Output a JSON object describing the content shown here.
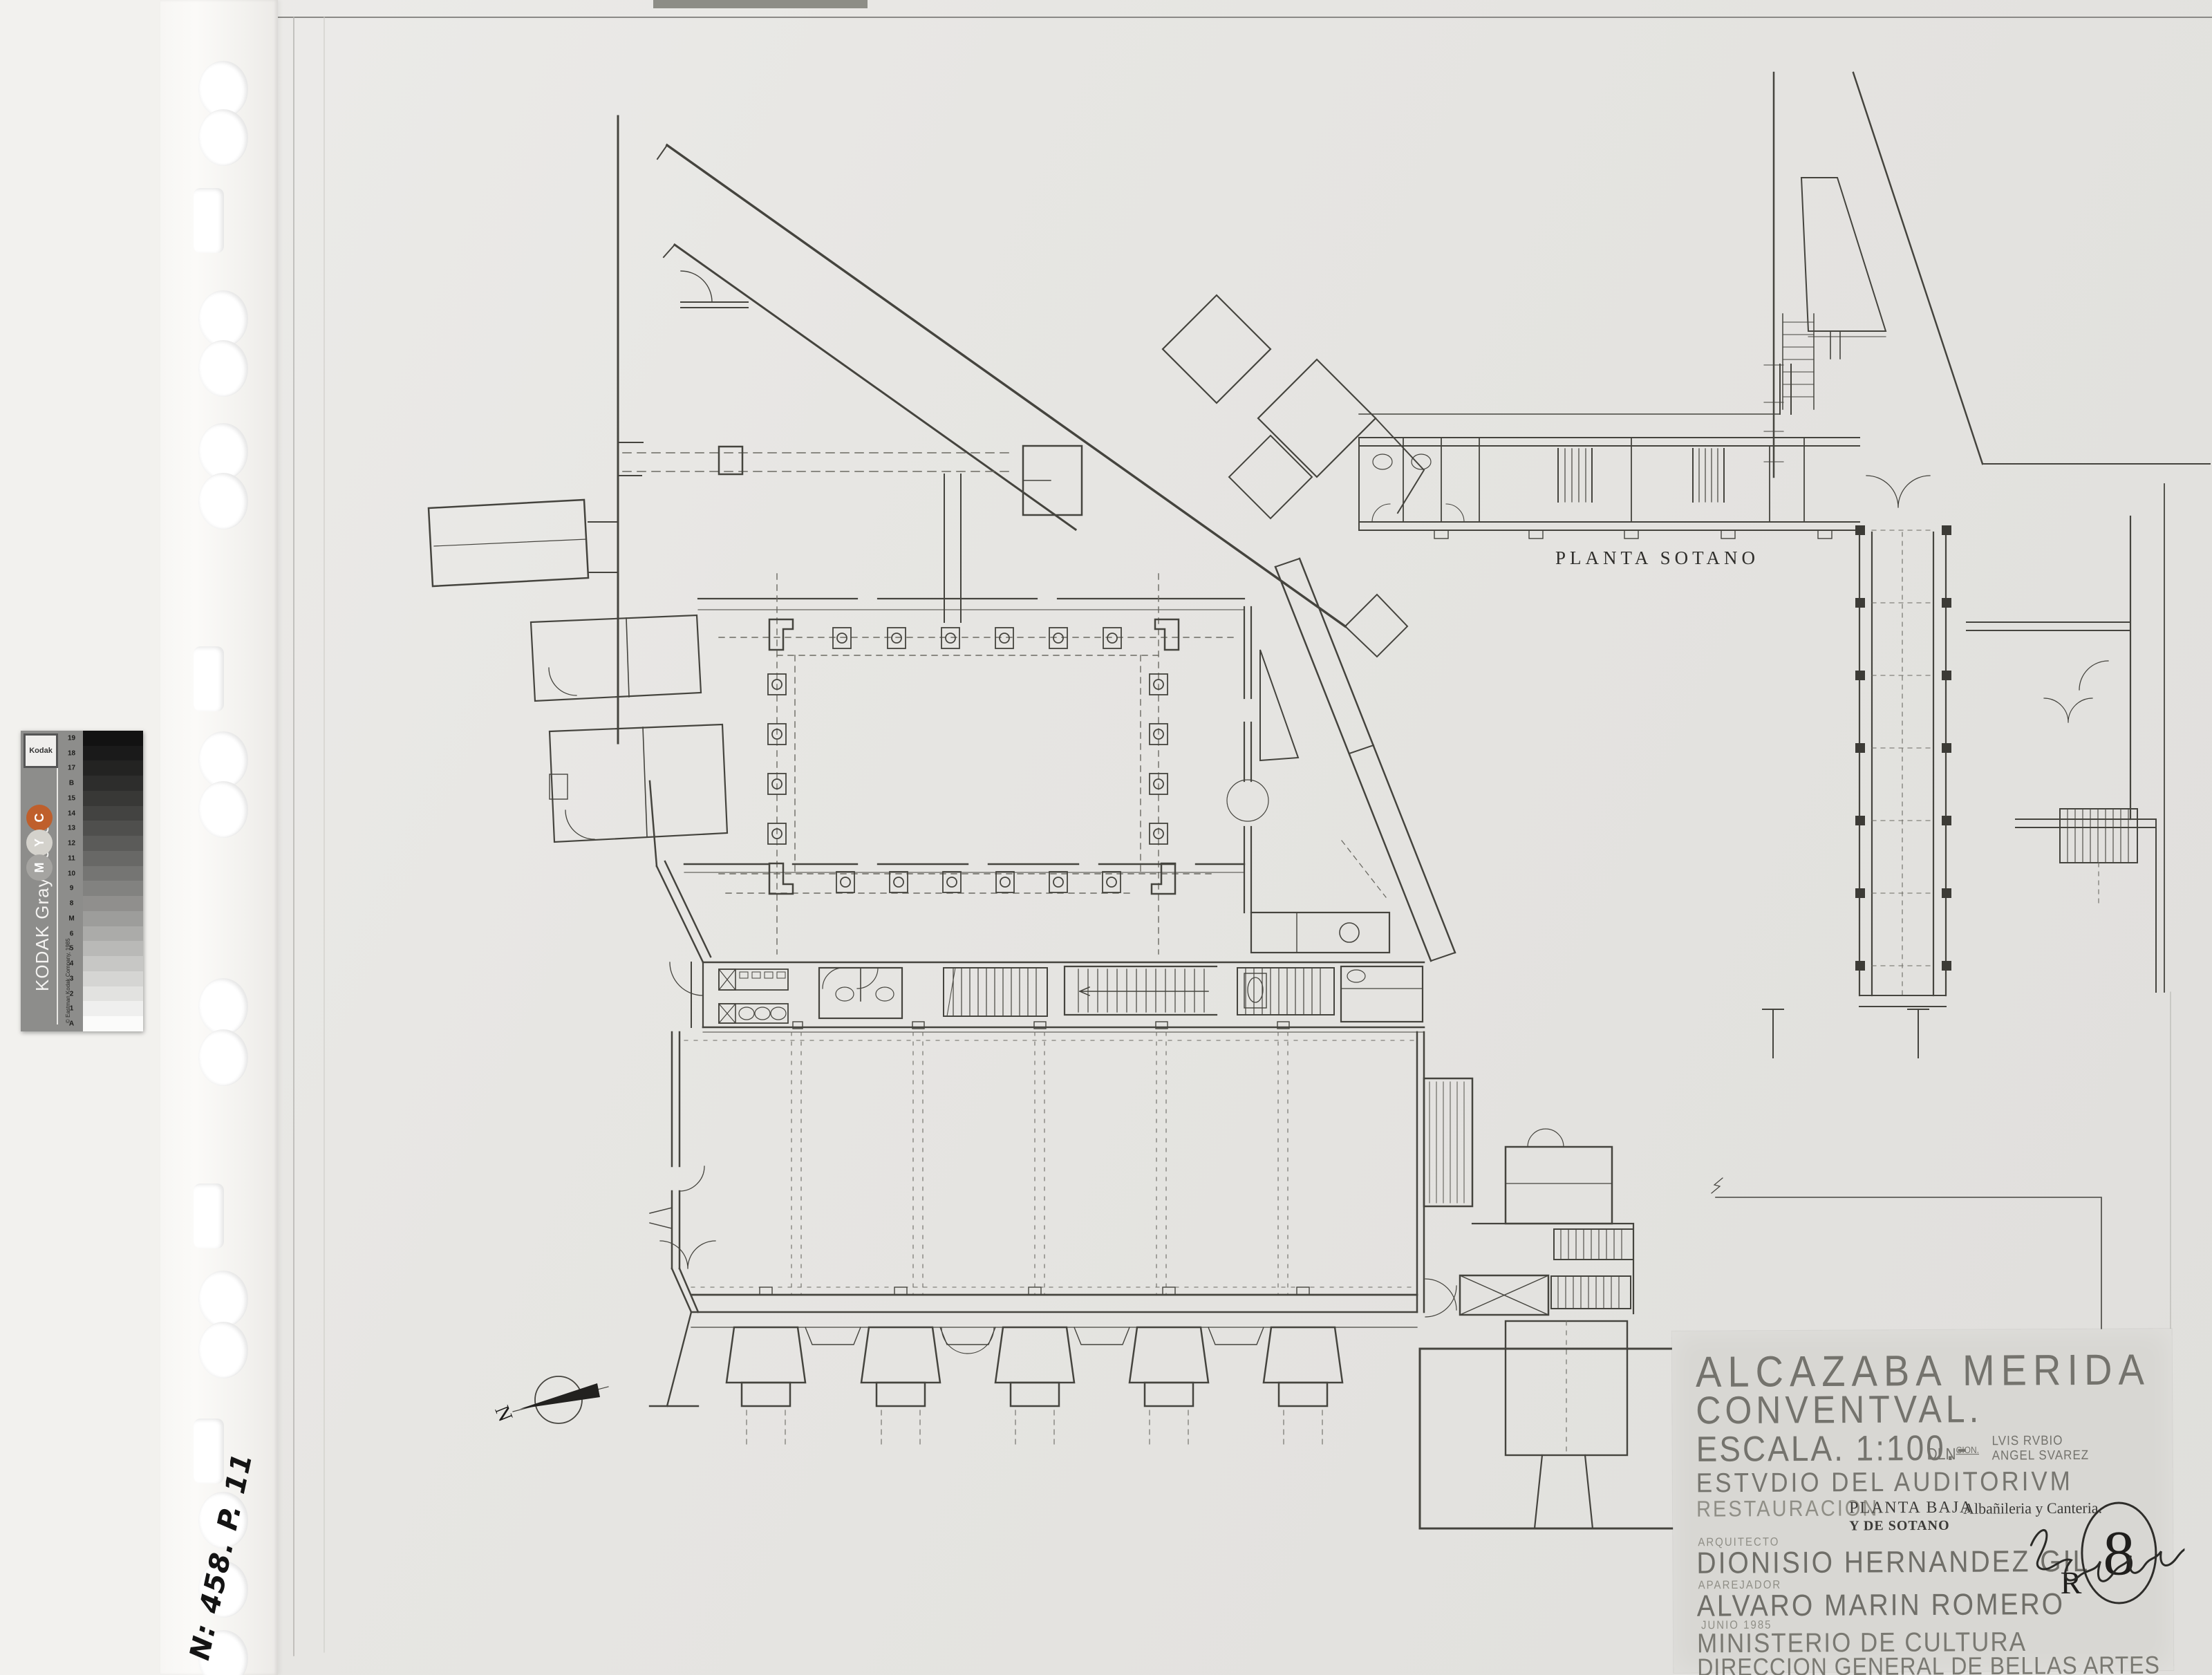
{
  "sheet": {
    "bg": "#e6e5e2",
    "line_color": "#45443e",
    "dash_color": "#6b6a63",
    "title_block_bg": "#d8d7d3"
  },
  "labels": {
    "sotano_title": "PLANTA SOTANO"
  },
  "title_block": {
    "line1": "ALCAZABA MERIDA",
    "line2": "CONVENTVAL.",
    "line3": "ESCALA. 1:100.-",
    "dln_label": "DLN",
    "dln_sup": "CION.",
    "drafters": [
      "LVIS RVBIO",
      "ANGEL SVAREZ"
    ],
    "line4": "ESTVDIO DEL AUDITORIVM",
    "restauracion": "RESTAURACION",
    "planta_baja": "PLANTA BAJA",
    "y_de_sotano": "Y DE SOTANO",
    "albanileria": "Albañileria y Canteria.",
    "arquitecto_label": "ARQUITECTO",
    "arquitecto": "DIONISIO HERNANDEZ GIL",
    "aparejador_label": "APAREJADOR",
    "aparejador": "ALVARO MARIN ROMERO",
    "date": "JUNIO 1985",
    "ministerio": "MINISTERIO DE CULTURA",
    "direccion": "DIRECCION GENERAL DE BELLAS ARTES",
    "revision_letter": "R",
    "revision_number": "8"
  },
  "annotations": {
    "handwritten_ref": "N: 458. P. 11",
    "north_letter": "N"
  },
  "kodak": {
    "brand": "Kodak",
    "title": "KODAK Gray Scale",
    "copyright": "© Eastman Kodak Company, 1985",
    "bg": "#8d8d8b",
    "dots": [
      {
        "label": "C",
        "color": "#bf5f2c"
      },
      {
        "label": "Y",
        "color": "#d4d2cc"
      },
      {
        "label": "M",
        "color": "#a5a4a1"
      }
    ],
    "steps": [
      {
        "label": "A",
        "color": "#fbfbfa"
      },
      {
        "label": "1",
        "color": "#efefee"
      },
      {
        "label": "2",
        "color": "#e2e2e0"
      },
      {
        "label": "3",
        "color": "#d5d5d3"
      },
      {
        "label": "4",
        "color": "#c7c7c5"
      },
      {
        "label": "5",
        "color": "#b9b9b7"
      },
      {
        "label": "6",
        "color": "#ababa9"
      },
      {
        "label": "M",
        "color": "#9d9d9b"
      },
      {
        "label": "8",
        "color": "#908f8d"
      },
      {
        "label": "9",
        "color": "#828280"
      },
      {
        "label": "10",
        "color": "#757573"
      },
      {
        "label": "11",
        "color": "#686866"
      },
      {
        "label": "12",
        "color": "#5b5b59"
      },
      {
        "label": "13",
        "color": "#4f4f4d"
      },
      {
        "label": "14",
        "color": "#434341"
      },
      {
        "label": "15",
        "color": "#383836"
      },
      {
        "label": "B",
        "color": "#2d2d2c"
      },
      {
        "label": "17",
        "color": "#232322"
      },
      {
        "label": "18",
        "color": "#1a1a1a"
      },
      {
        "label": "19",
        "color": "#121212"
      }
    ]
  }
}
